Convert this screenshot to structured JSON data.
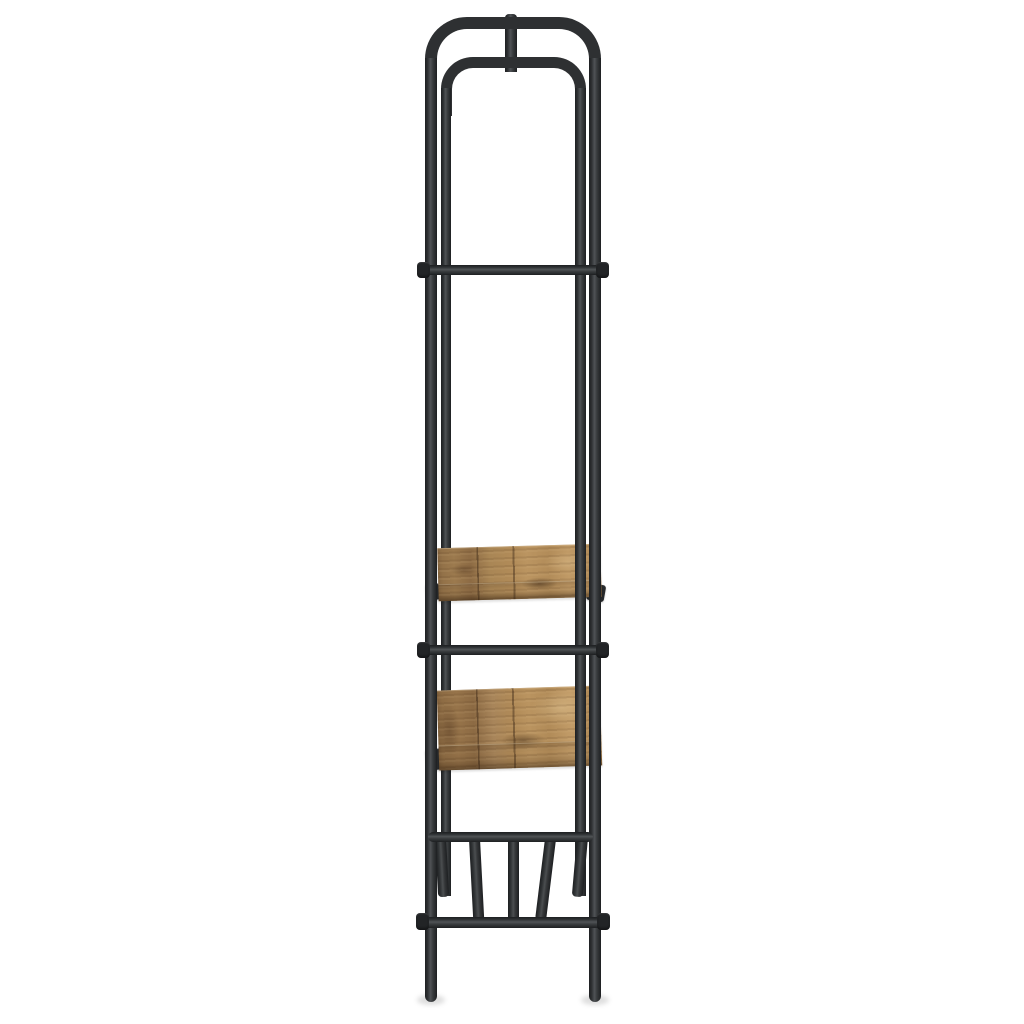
{
  "meta": {
    "type": "product-photo",
    "description": "Side view of an industrial-style clothes rack: black steel tube frame with top garment rail loop, two rustic brown wooden shelves in the middle, a slatted steel tube shoe shelf near the bottom, on a plain white background",
    "background": "#ffffff"
  },
  "colors": {
    "metal": "#2e3032",
    "metal_edge": "#1d1f21",
    "metal_highlight": "#505356",
    "collar": "#222426",
    "wood_base": "#ad8756",
    "wood_light": "#c49e6a",
    "wood_dark": "#7a5a38",
    "foot_shadow": "rgba(0,0,0,0.13)"
  },
  "parts": {
    "frame": "steel-tube-frame",
    "garment_rail": "inner-hanger-loop",
    "upper_shelf": "wooden-shelf",
    "lower_shelf": "wooden-shelf",
    "bottom_rack": "slatted-tube-shelf"
  }
}
